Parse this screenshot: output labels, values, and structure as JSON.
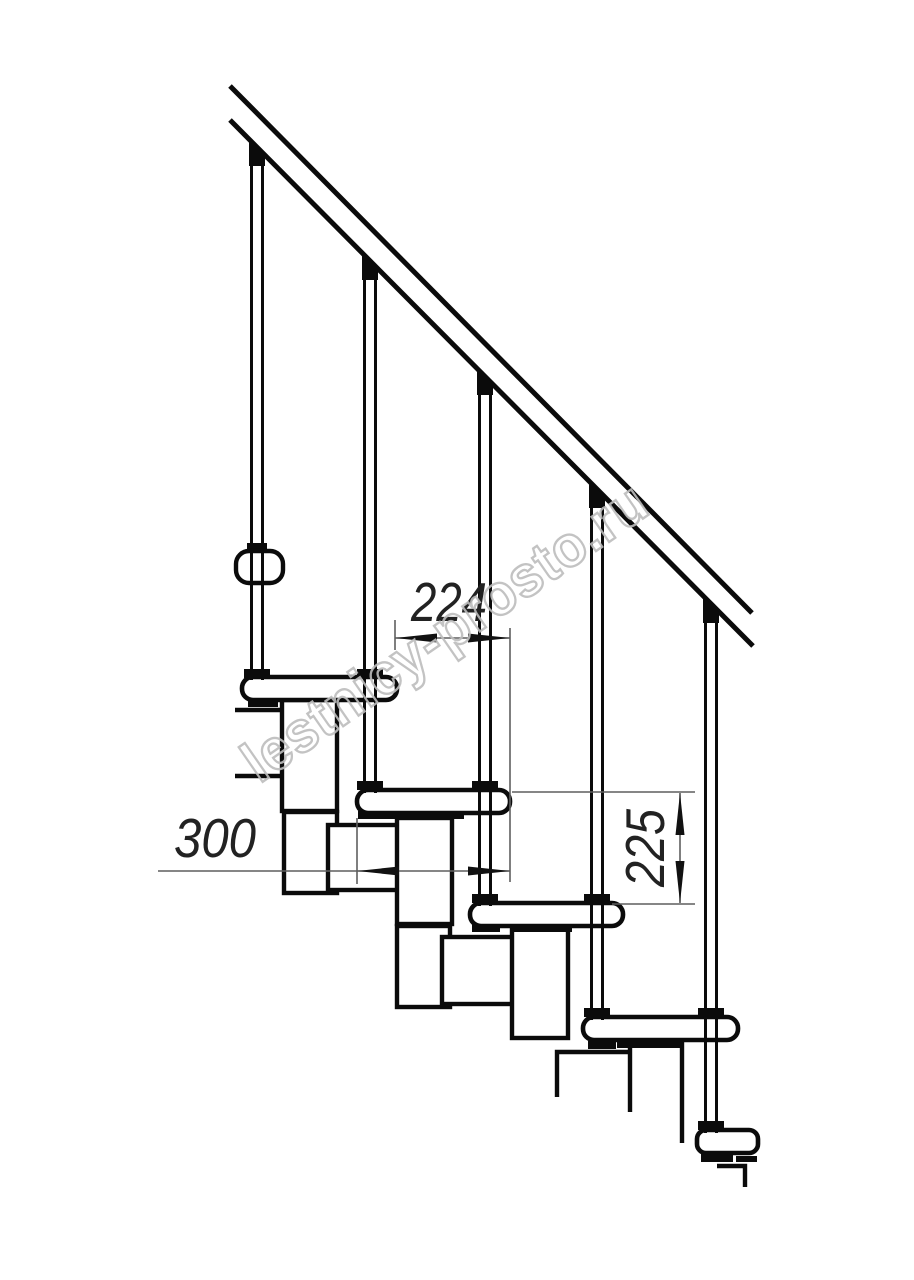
{
  "drawing": {
    "type": "staircase-fragment-side-view",
    "background": "#ffffff",
    "line_color": "#0b0b0b",
    "thin_line_color": "#5f5f5f",
    "dimension_text_color": "#222222",
    "watermark": {
      "text": "lestnicy-prosto.ru",
      "color": "#bdbdbd"
    },
    "dimensions": [
      {
        "id": "step-run",
        "label": "224",
        "orientation": "horizontal"
      },
      {
        "id": "tread-depth",
        "label": "300",
        "orientation": "horizontal"
      },
      {
        "id": "step-rise",
        "label": "225",
        "orientation": "vertical"
      }
    ],
    "counts": {
      "balusters": 5,
      "treads": 5,
      "support_modules": 5
    }
  }
}
